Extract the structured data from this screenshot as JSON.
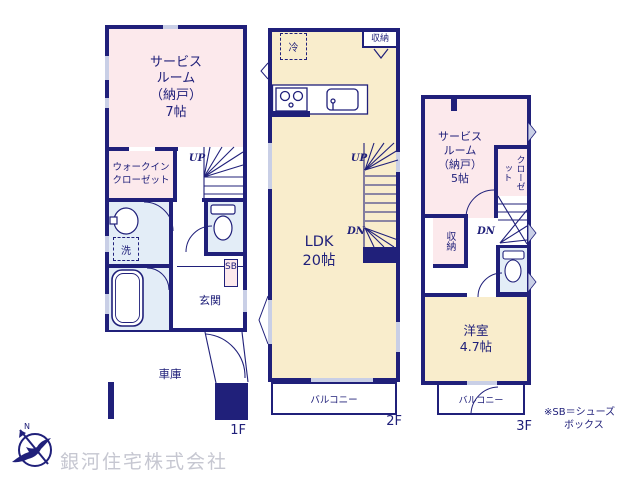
{
  "colors": {
    "wall_navy": "#20207a",
    "room_pink": "#fce9ec",
    "room_cream": "#f9edcc",
    "room_blue": "#e3edf7",
    "window_gray": "#c9cfe6",
    "watermark_gray": "#c6c7d1"
  },
  "f1": {
    "label": "1F",
    "service_room": "サービス\nルーム\n（納戸）\n7帖",
    "walkin_closet": "ウォークイン\nクローゼット",
    "washer": "洗",
    "entrance": "玄関",
    "garage": "車庫",
    "shoebox": "SB",
    "up": "UP"
  },
  "f2": {
    "label": "2F",
    "ldk": "LDK\n20帖",
    "fridge": "冷",
    "storage": "収納",
    "balcony": "バルコニー",
    "up": "UP",
    "dn": "DN"
  },
  "f3": {
    "label": "3F",
    "service_room": "サービス\nルーム\n（納戸）\n5帖",
    "closet": "クローゼット",
    "storage": "収納",
    "western_room": "洋室\n4.7帖",
    "balcony": "バルコニー",
    "dn": "DN"
  },
  "footer": {
    "company": "銀河住宅株式会社",
    "note": "※SB＝シューズ\n　　ボックス",
    "compass_n": "N"
  }
}
